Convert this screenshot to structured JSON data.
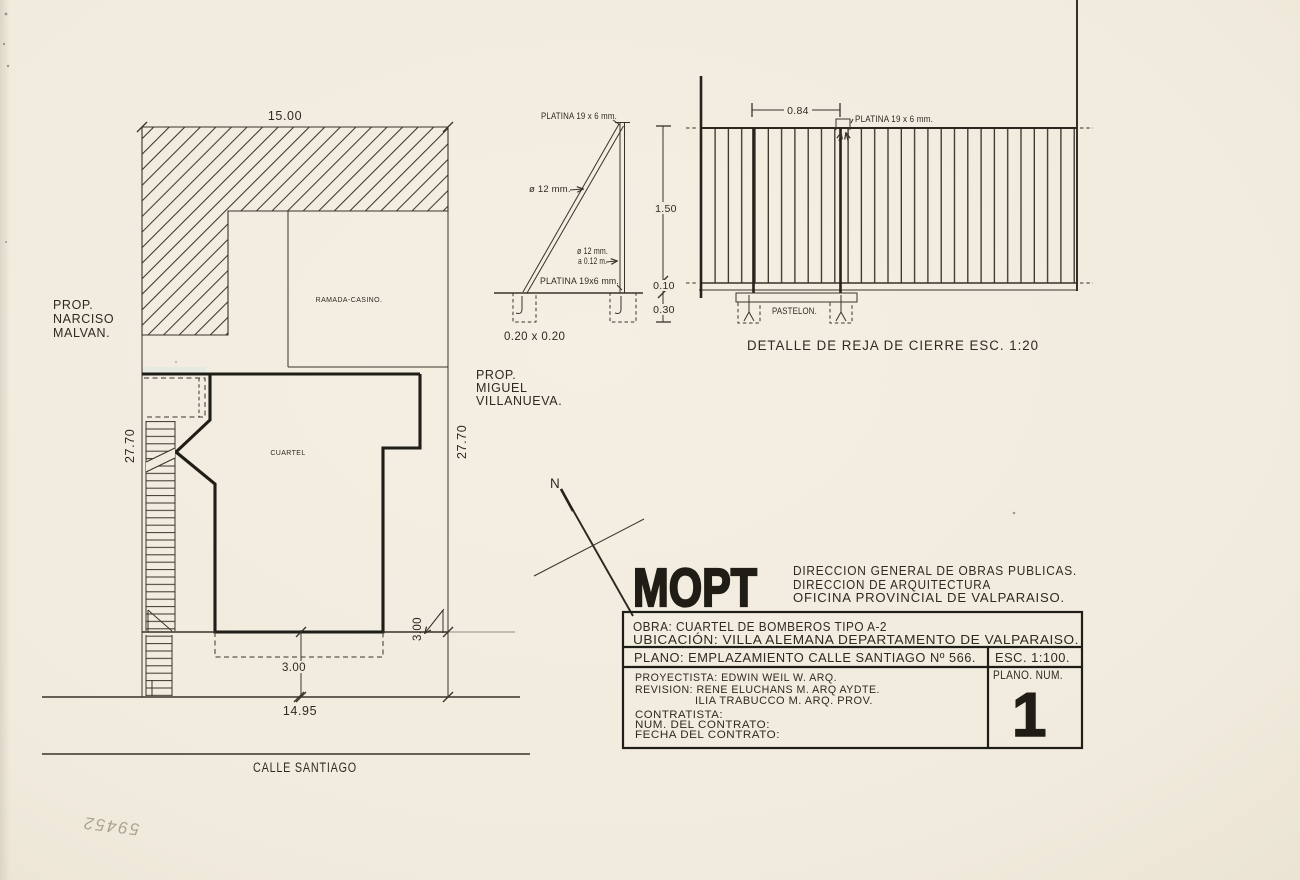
{
  "page": {
    "sheet_number_handwritten": "59452"
  },
  "site_plan": {
    "dim_width_top": "15.00",
    "dim_depth_left": "27.70",
    "dim_depth_right": "27.70",
    "dim_frontage": "14.95",
    "dim_setback_center": "3.00",
    "dim_setback_right": "3.00",
    "prop_left_line1": "PROP.",
    "prop_left_line2": "NARCISO",
    "prop_left_line3": "MALVAN.",
    "prop_right_line1": "PROP.",
    "prop_right_line2": "MIGUEL",
    "prop_right_line3": "VILLANUEVA.",
    "room_label": "RAMADA-CASINO.",
    "building_label": "CUARTEL",
    "street_name": "CALLE SANTIAGO",
    "north_label": "N"
  },
  "fence_detail": {
    "caption": "DETALLE DE REJA DE CIERRE ESC. 1:20",
    "side_view": {
      "platina_top": "PLATINA 19 x 6 mm.",
      "bar_dia": "ø 12 mm.",
      "bar_dia_2": "ø 12 mm.",
      "bar_spacing": "a 0.12 m.",
      "platina_bottom": "PLATINA 19x6 mm.",
      "footing_size": "0.20 x 0.20",
      "dim_height": "1.50",
      "dim_rail": "0.10",
      "dim_footing": "0.30"
    },
    "front_view": {
      "dim_post_spacing": "0.84",
      "platina": "PLATINA 19 x 6 mm.",
      "base_label": "PASTELON."
    }
  },
  "title_block": {
    "logo": "MOPT",
    "org_line1": "DIRECCION GENERAL DE OBRAS PUBLICAS.",
    "org_line2": "DIRECCION DE ARQUITECTURA",
    "org_line3": "OFICINA PROVINCIAL DE VALPARAISO.",
    "obra": "OBRA: CUARTEL DE BOMBEROS TIPO A-2",
    "ubicacion": "UBICACIÓN: VILLA ALEMANA DEPARTAMENTO DE VALPARAISO.",
    "plano": "PLANO: EMPLAZAMIENTO CALLE SANTIAGO Nº 566.",
    "escala": "ESC. 1:100.",
    "proyectista": "PROYECTISTA: EDWIN WEIL W. ARQ.",
    "revision_line1": "REVISION: RENE ELUCHANS M. ARQ AYDTE.",
    "revision_line2": "ILIA TRABUCCO M. ARQ. PROV.",
    "contratista": "CONTRATISTA:",
    "num_contrato": "NUM. DEL CONTRATO:",
    "fecha_contrato": "FECHA DEL CONTRATO:",
    "plano_num_label": "PLANO. NUM.",
    "plano_num": "1"
  },
  "colors": {
    "paper": "#f1ebde",
    "ink": "#38332a",
    "heavy_ink": "#1f1d17"
  }
}
